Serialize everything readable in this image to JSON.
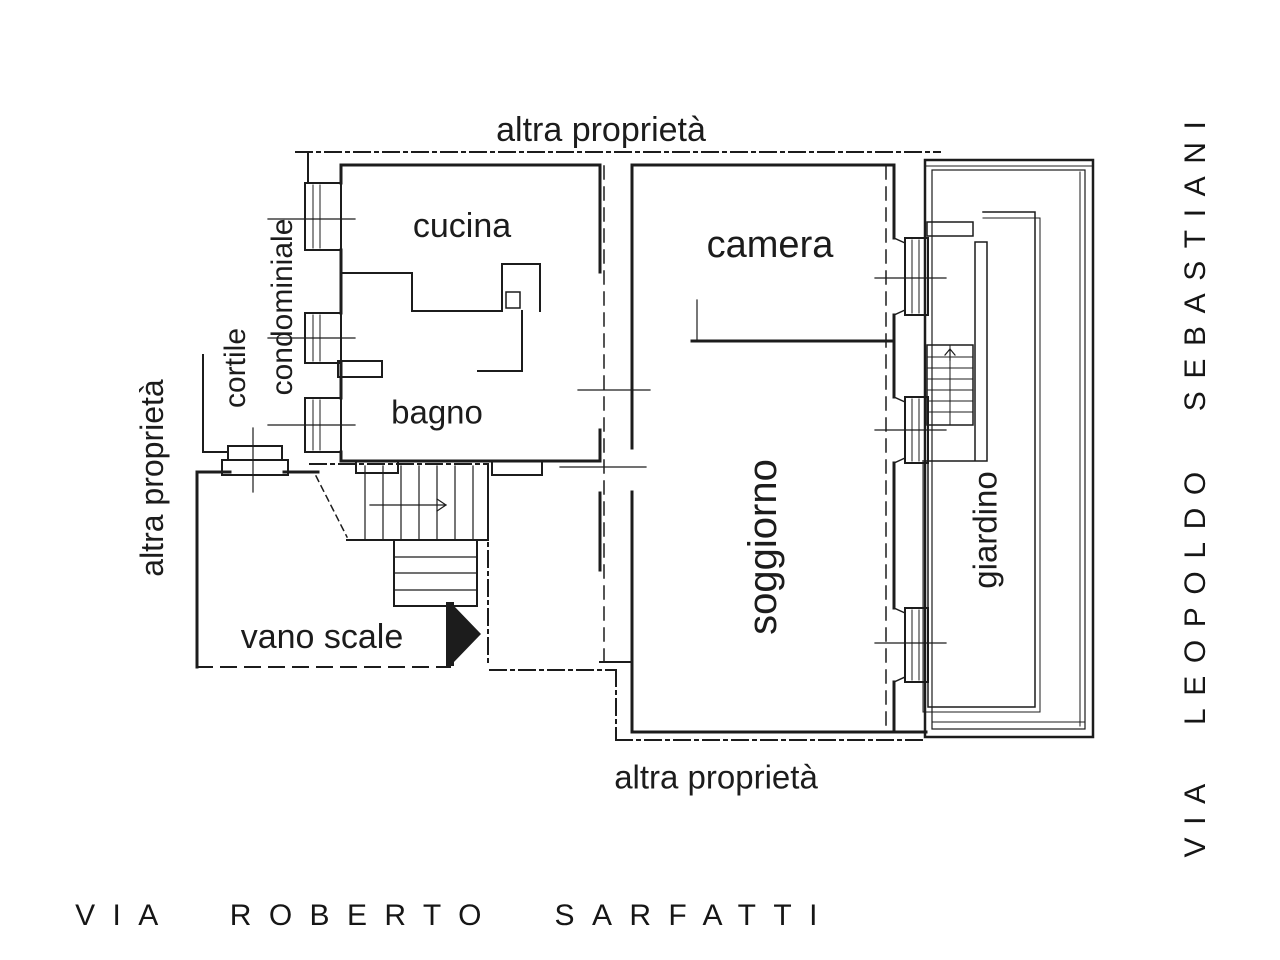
{
  "plan": {
    "boundary_labels": {
      "top": "altra proprietà",
      "left": "altra proprietà",
      "bottom": "altra proprietà"
    },
    "rooms": {
      "cucina": "cucina",
      "bagno": "bagno",
      "camera": "camera",
      "soggiorno": "soggiorno",
      "giardino": "giardino",
      "vano_scale": "vano scale"
    },
    "courtyard": {
      "line1": "cortile",
      "line2": "condominiale"
    },
    "streets": {
      "bottom": "VIA ROBERTO SARFATTI",
      "right": "VIA LEOPOLDO SEBASTIANI"
    },
    "colors": {
      "line": "#1c1c1c",
      "text": "#1c1c1c",
      "background": "#ffffff"
    }
  }
}
